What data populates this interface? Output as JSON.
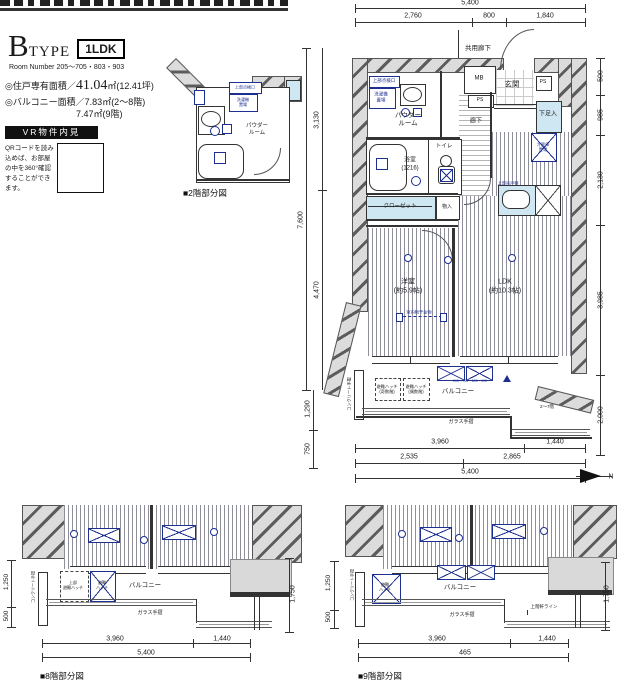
{
  "title_block": {
    "letter": "B",
    "word": "TYPE",
    "tag": "1LDK",
    "room_number": "Room Number 205〜705・803・903",
    "area1_prefix": "◎住戸専有面積／",
    "area1_value": "41.04",
    "area1_suffix": "㎡(12.41坪)",
    "area2": "◎バルコニー面積／7.83㎡(2〜8階)",
    "area3": "7.47㎡(9階)"
  },
  "vr": {
    "title": "VR物件内見",
    "body": "QRコードを読み込めば、お部屋の中を360°確認することができます。"
  },
  "captions": {
    "f2": "■2階部分図",
    "f8": "■8階部分図",
    "f9": "■9階部分図"
  },
  "colors": {
    "annotation_blue": "#1d2f8f",
    "fixture_cyan": "#cfe7f2",
    "wall_gray": "#dcdcdc"
  },
  "labels": [
    {
      "n": "corridor-common-label",
      "t": "共用廊下",
      "x": 478,
      "y": 49,
      "fs": 6.5
    },
    {
      "n": "entrance-label",
      "t": "玄関",
      "x": 512,
      "y": 84,
      "fs": 7.5
    },
    {
      "n": "meter-box-label",
      "t": "MB",
      "x": 479,
      "y": 79,
      "fs": 6
    },
    {
      "n": "ps-top-label",
      "t": "PS",
      "x": 480,
      "y": 100,
      "fs": 5
    },
    {
      "n": "ps-right-label",
      "t": "PS",
      "x": 543,
      "y": 82,
      "fs": 5
    },
    {
      "n": "shoe-cabinet-label",
      "t": "下足入",
      "x": 548,
      "y": 115,
      "fs": 6
    },
    {
      "n": "hallway-label",
      "t": "廊下",
      "x": 476,
      "y": 122,
      "fs": 6
    },
    {
      "n": "powder-room-label",
      "t": "パウダー\nルーム",
      "x": 408,
      "y": 120,
      "fs": 6.5
    },
    {
      "n": "laundry-space-label",
      "t": "洗濯機\n置場",
      "x": 381,
      "y": 97,
      "fs": 4.5,
      "c": "#1d2f8f"
    },
    {
      "n": "inspection-port-label",
      "t": "上部点検口",
      "x": 384,
      "y": 81,
      "fs": 4.5,
      "c": "#1d2f8f"
    },
    {
      "n": "bathroom-label",
      "t": "浴室\n(1216)",
      "x": 410,
      "y": 165,
      "fs": 6
    },
    {
      "n": "toilet-label",
      "t": "トイレ",
      "x": 444,
      "y": 147,
      "fs": 5.5
    },
    {
      "n": "closet-label",
      "t": "クローゼット",
      "x": 400,
      "y": 207,
      "fs": 5.5
    },
    {
      "n": "storage-label",
      "t": "物入",
      "x": 447,
      "y": 207,
      "fs": 5
    },
    {
      "n": "fridge-label",
      "t": "冷蔵庫\n置場",
      "x": 543,
      "y": 147,
      "fs": 4.2,
      "c": "#1d2f8f"
    },
    {
      "n": "kitchen-shelf-label",
      "t": "上部吊戸棚",
      "x": 508,
      "y": 183,
      "fs": 4.2,
      "c": "#1d2f8f"
    },
    {
      "n": "bedroom-label",
      "t": "洋室\n(約5.9帖)",
      "x": 408,
      "y": 287,
      "fs": 7
    },
    {
      "n": "ldk-label",
      "t": "LDK\n(約10.3帖)",
      "x": 505,
      "y": 287,
      "fs": 7
    },
    {
      "n": "laundry-bar-label",
      "t": "室内物干金物",
      "x": 419,
      "y": 312,
      "fs": 4.2,
      "c": "#1d2f8f"
    },
    {
      "n": "balcony-label",
      "t": "バルコニー",
      "x": 458,
      "y": 392,
      "fs": 6.5
    },
    {
      "n": "hatch-odd-label",
      "t": "避難ハッチ\n(奇数階)",
      "x": 387,
      "y": 389,
      "fs": 4.2
    },
    {
      "n": "hatch-even-label",
      "t": "避難ハッチ\n(偶数階)",
      "x": 416,
      "y": 389,
      "fs": 4.2
    },
    {
      "n": "balcony-room-numbers",
      "t": "205〜705・803・903",
      "x": 470,
      "y": 381,
      "fs": 3.5,
      "c": "#1d2f8f"
    },
    {
      "n": "glass-rail-label",
      "t": "ガラス手摺",
      "x": 461,
      "y": 422,
      "fs": 5
    },
    {
      "n": "floors-2-7-label",
      "t": "2〜7階",
      "x": 547,
      "y": 407,
      "fs": 4.5
    },
    {
      "n": "concrete-rail-label",
      "t": "コンクリート手摺",
      "x": 349,
      "y": 394,
      "fs": 4.2,
      "r": -90
    },
    {
      "n": "compass-north-label",
      "t": "N",
      "x": 611,
      "y": 478,
      "fs": 7
    },
    {
      "n": "dim-top-total",
      "t": "5,400",
      "x": 470,
      "y": 4,
      "fs": 7
    },
    {
      "n": "dim-top-1",
      "t": "2,760",
      "x": 413,
      "y": 17,
      "fs": 7
    },
    {
      "n": "dim-top-2",
      "t": "800",
      "x": 489,
      "y": 17,
      "fs": 7
    },
    {
      "n": "dim-top-3",
      "t": "1,840",
      "x": 545,
      "y": 17,
      "fs": 7
    },
    {
      "n": "dim-left-total",
      "t": "7,600",
      "x": 302,
      "y": 220,
      "fs": 7,
      "r": -90
    },
    {
      "n": "dim-left-1",
      "t": "3,130",
      "x": 318,
      "y": 120,
      "fs": 7,
      "r": -90
    },
    {
      "n": "dim-left-2",
      "t": "4,470",
      "x": 318,
      "y": 290,
      "fs": 7,
      "r": -90
    },
    {
      "n": "dim-left-3",
      "t": "1,290",
      "x": 309,
      "y": 409,
      "fs": 7,
      "r": -90
    },
    {
      "n": "dim-left-4",
      "t": "750",
      "x": 309,
      "y": 449,
      "fs": 7,
      "r": -90
    },
    {
      "n": "dim-right-1",
      "t": "500",
      "x": 602,
      "y": 76,
      "fs": 7,
      "r": -90
    },
    {
      "n": "dim-right-2",
      "t": "985",
      "x": 602,
      "y": 115,
      "fs": 7,
      "r": -90
    },
    {
      "n": "dim-right-3",
      "t": "2,130",
      "x": 602,
      "y": 180,
      "fs": 7,
      "r": -90
    },
    {
      "n": "dim-right-4",
      "t": "3,985",
      "x": 602,
      "y": 300,
      "fs": 7,
      "r": -90
    },
    {
      "n": "dim-right-5",
      "t": "2,000",
      "x": 602,
      "y": 415,
      "fs": 7,
      "r": -90
    },
    {
      "n": "dim-bottom-1",
      "t": "3,960",
      "x": 440,
      "y": 443,
      "fs": 7
    },
    {
      "n": "dim-bottom-2",
      "t": "1,440",
      "x": 555,
      "y": 443,
      "fs": 7
    },
    {
      "n": "dim-bottom-3",
      "t": "2,535",
      "x": 409,
      "y": 458,
      "fs": 7
    },
    {
      "n": "dim-bottom-4",
      "t": "2,865",
      "x": 512,
      "y": 458,
      "fs": 7
    },
    {
      "n": "dim-bottom-total",
      "t": "5,400",
      "x": 470,
      "y": 473,
      "fs": 7
    },
    {
      "n": "f2-inspection-label",
      "t": "上部点検口",
      "x": 245,
      "y": 87,
      "fs": 4,
      "c": "#1d2f8f"
    },
    {
      "n": "f2-laundry-label",
      "t": "洗濯機\n置場",
      "x": 243,
      "y": 102,
      "fs": 4,
      "c": "#1d2f8f"
    },
    {
      "n": "f2-powder-label",
      "t": "パウダー\nルーム",
      "x": 257,
      "y": 130,
      "fs": 5.5
    },
    {
      "n": "f8-balcony-label",
      "t": "バルコニー",
      "x": 145,
      "y": 586,
      "fs": 6.5
    },
    {
      "n": "f8-hatch-upper-label",
      "t": "上部\n避難ハッチ",
      "x": 73,
      "y": 585,
      "fs": 4
    },
    {
      "n": "f8-hatch-label",
      "t": "避難\nハッチ",
      "x": 102,
      "y": 585,
      "fs": 4
    },
    {
      "n": "f8-glass-rail-label",
      "t": "ガラス手摺",
      "x": 150,
      "y": 613,
      "fs": 5
    },
    {
      "n": "f8-concrete-rail-label",
      "t": "コンクリート手摺",
      "x": 33,
      "y": 587,
      "fs": 4,
      "r": -90
    },
    {
      "n": "f8-dim-1",
      "t": "3,960",
      "x": 115,
      "y": 640,
      "fs": 7
    },
    {
      "n": "f8-dim-2",
      "t": "1,440",
      "x": 222,
      "y": 640,
      "fs": 7
    },
    {
      "n": "f8-dim-total",
      "t": "5,400",
      "x": 146,
      "y": 654,
      "fs": 7
    },
    {
      "n": "f8-dim-left-1",
      "t": "1,250",
      "x": 7,
      "y": 582,
      "fs": 6.5,
      "r": -90
    },
    {
      "n": "f8-dim-left-2",
      "t": "500",
      "x": 7,
      "y": 616,
      "fs": 6.5,
      "r": -90
    },
    {
      "n": "f8-dim-right",
      "t": "1,750",
      "x": 294,
      "y": 594,
      "fs": 7,
      "r": -90
    },
    {
      "n": "f9-balcony-label",
      "t": "バルコニー",
      "x": 460,
      "y": 588,
      "fs": 6.5
    },
    {
      "n": "f9-hatch-label",
      "t": "避難\nハッチ",
      "x": 385,
      "y": 587,
      "fs": 4
    },
    {
      "n": "f9-glass-rail-label",
      "t": "ガラス手摺",
      "x": 462,
      "y": 615,
      "fs": 5
    },
    {
      "n": "f9-eave-label",
      "t": "上階軒ライン",
      "x": 544,
      "y": 607,
      "fs": 4.5
    },
    {
      "n": "f9-partition-label",
      "t": "コンクリート手摺",
      "x": 352,
      "y": 585,
      "fs": 4,
      "r": -90
    },
    {
      "n": "f9-dim-left-1",
      "t": "1,250",
      "x": 329,
      "y": 583,
      "fs": 6.5,
      "r": -90
    },
    {
      "n": "f9-dim-left-2",
      "t": "500",
      "x": 329,
      "y": 617,
      "fs": 6.5,
      "r": -90
    },
    {
      "n": "f9-dim-1",
      "t": "3,960",
      "x": 437,
      "y": 640,
      "fs": 7
    },
    {
      "n": "f9-dim-2",
      "t": "1,440",
      "x": 547,
      "y": 640,
      "fs": 7
    },
    {
      "n": "f9-dim-total",
      "t": "465",
      "x": 465,
      "y": 654,
      "fs": 7
    },
    {
      "n": "f9-dim-right",
      "t": "1,750",
      "x": 608,
      "y": 594,
      "fs": 7,
      "r": -90
    }
  ]
}
